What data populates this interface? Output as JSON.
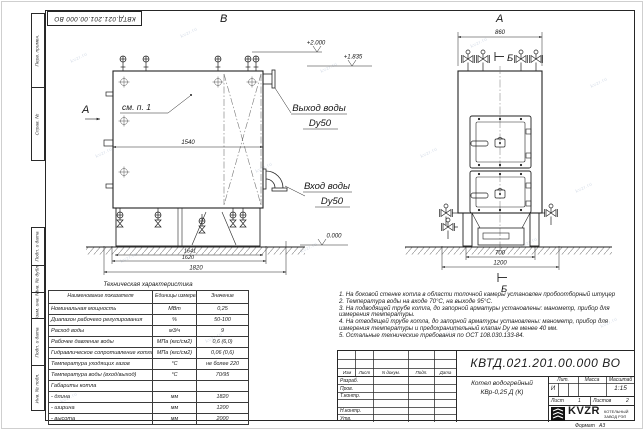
{
  "watermark": {
    "text": "kvzr.ru"
  },
  "frame": {
    "left_top": [
      "Перв. примен.",
      "Справ. №"
    ],
    "left_bottom": [
      "Подп. и дата",
      "Инв. № дубл.",
      "Взам. инв. №",
      "Подп. и дата",
      "Инв. № подл."
    ],
    "format_label": "Формат",
    "format_value": "А3"
  },
  "views": {
    "front": {
      "label_v": "В",
      "label_a": "А",
      "see_note": "см. п. 1",
      "dim_width": "1540",
      "dim_base1": "1641",
      "dim_base2": "1620",
      "dim_length": "1820",
      "outlet": {
        "line1": "Выход воды",
        "line2": "Dy50"
      },
      "inlet": {
        "line1": "Вход воды",
        "line2": "Dy50"
      },
      "elev_top": "+2.000",
      "elev_mid": "+1.835",
      "elev_zero": "0.000"
    },
    "side": {
      "label_top": "А",
      "section": "Б",
      "dim_top": "860",
      "dim_base": "700",
      "dim_width": "1200"
    }
  },
  "table": {
    "title": "Техническая характеристика",
    "headers": [
      "Наименование показателя",
      "Единицы измерения",
      "Значение"
    ],
    "rows": [
      {
        "name": "Номинальная мощность",
        "unit": "МВт",
        "value": "0,25"
      },
      {
        "name": "Диапазон рабочего регулирования",
        "unit": "%",
        "value": "50-100"
      },
      {
        "name": "Расход воды",
        "unit": "м3/ч",
        "value": "9"
      },
      {
        "name": "Рабочее давление воды",
        "unit": "МПа (кгс/см2)",
        "value": "0,6 (6,0)"
      },
      {
        "name": "Гидравлическое сопротивление котла",
        "unit": "МПа (кгс/см2)",
        "value": "0,06 (0,6)"
      },
      {
        "name": "Температура уходящих газов",
        "unit": "°С",
        "value": "не более 220"
      },
      {
        "name": "Температура воды (вход/выход)",
        "unit": "°С",
        "value": "70/95"
      },
      {
        "name": "Габариты котла",
        "unit": "",
        "value": ""
      },
      {
        "name": "- длина",
        "unit": "мм",
        "value": "1820"
      },
      {
        "name": "- ширина",
        "unit": "мм",
        "value": "1200"
      },
      {
        "name": "- высота",
        "unit": "мм",
        "value": "2000"
      }
    ]
  },
  "notes": {
    "lines": [
      "1.  На боковой стенке котла в области топочной камеры установлен пробоотборный штуцер",
      "2.  Температура воды на входе 70°С, на выходе 95°С.",
      "3.  На подводящей трубе котла, до запорной арматуры установлены: манометр, прибор для",
      "измерения температуры.",
      "4.  На отводящей трубе котла, до запорной арматуры установлены: манометр, прибор для",
      "измерения температуры и предохранительный клапан Dу не менее 40 мм.",
      "5.  Остальные технические требования по ОСТ 108.030.133-84."
    ]
  },
  "titleblock": {
    "doc_number": "КВТД.021.201.00.000  ВО",
    "name_line1": "Котел водогрейный",
    "name_line2": "КВр-0,25 Д (К)",
    "rev_headers": [
      "Изм",
      "Лист",
      "N докум.",
      "Подп.",
      "Дата"
    ],
    "sign_rows": [
      "Разраб.",
      "Пров.",
      "Т.контр.",
      "",
      "Н.контр.",
      "Утв."
    ],
    "lit_header": "Лит.",
    "mass_header": "Масса",
    "scale_header": "Масштаб",
    "lit_value": "И",
    "scale_value": "1:15",
    "sheet_label": "Лист",
    "sheet_value": "1",
    "sheets_label": "Листов",
    "sheets_value": "2",
    "logo_text": "KVZR",
    "logo_sub1": "КОТЕЛЬНЫЙ",
    "logo_sub2": "ЗАВОД РЭП"
  }
}
